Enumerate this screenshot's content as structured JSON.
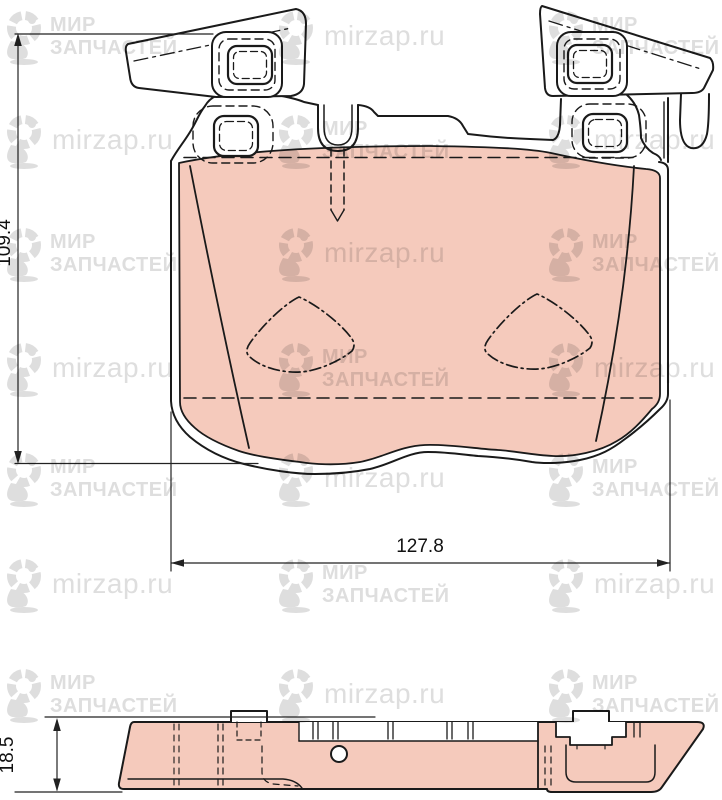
{
  "front_view": {
    "height_dim": "109.4",
    "width_dim": "127.8"
  },
  "profile_view": {
    "thickness_dim": "18.5"
  },
  "watermark": {
    "brand_line1": "МИР",
    "brand_line2": "ЗАПЧАСТЕЙ",
    "site": "mirzap.ru",
    "color": "#dedede",
    "rows_y": [
      8,
      112,
      225,
      340,
      450,
      556,
      666
    ],
    "cols_x": [
      2,
      274,
      544
    ]
  },
  "colors": {
    "friction_material": "#f5cabc",
    "line": "#1a1a1a",
    "background": "#ffffff"
  }
}
